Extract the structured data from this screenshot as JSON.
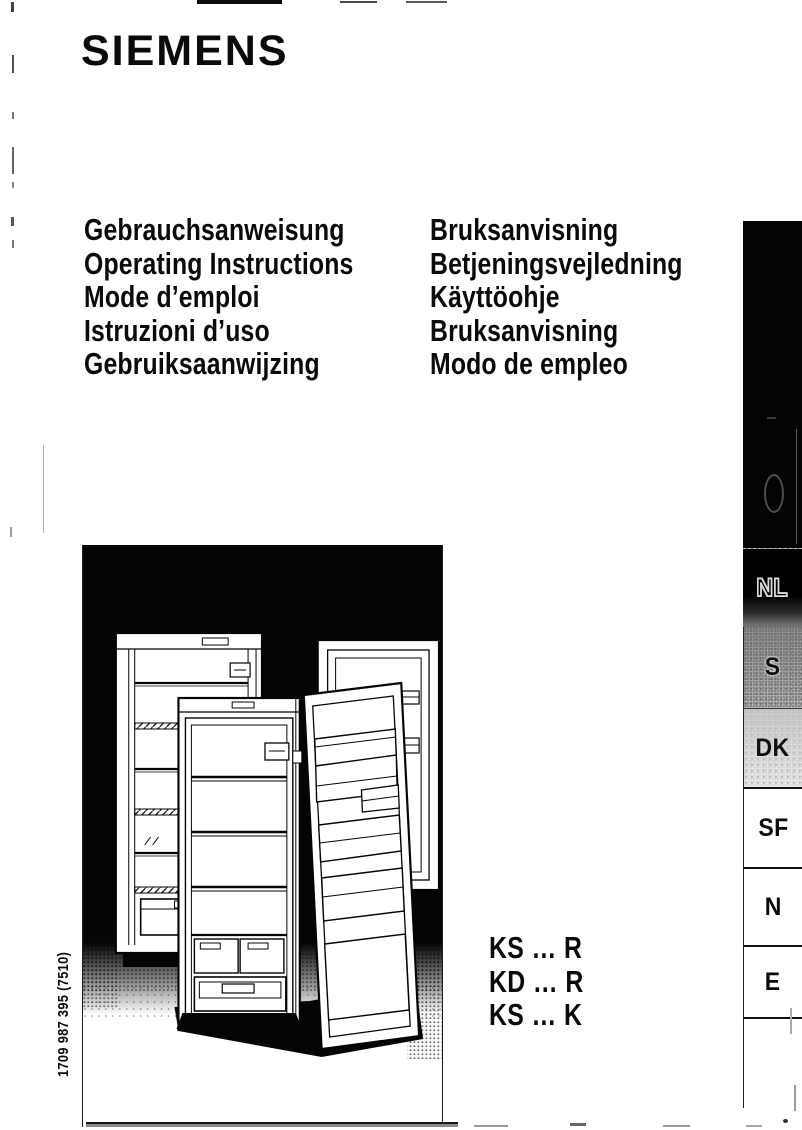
{
  "brand": {
    "logo": "SIEMENS"
  },
  "titles_left": [
    "Gebrauchsanweisung",
    "Operating Instructions",
    "Mode d’emploi",
    "Istruzioni d’uso",
    "Gebruiksaanwijzing"
  ],
  "titles_right": [
    "Bruksanvisning",
    "Betjeningsvejledning",
    "Käyttöohje",
    "Bruksanvisning",
    "Modo de empleo"
  ],
  "models": [
    "KS … R",
    "KD … R",
    "KS … K"
  ],
  "part_number": "1709 987 395 (7510)",
  "tabs": [
    {
      "label": "",
      "variant": "black-tall"
    },
    {
      "label": "NL",
      "variant": "black"
    },
    {
      "label": "S",
      "variant": "grey-dark"
    },
    {
      "label": "DK",
      "variant": "grey-light"
    },
    {
      "label": "SF",
      "variant": "white"
    },
    {
      "label": "N",
      "variant": "white"
    },
    {
      "label": "E",
      "variant": "white"
    },
    {
      "label": "",
      "variant": "empty"
    }
  ],
  "figure": {
    "name": "three-open-refrigerators-line-art"
  },
  "colors": {
    "ink": "#0a0a0a",
    "page": "#ffffff",
    "figure_background": "#050505",
    "tab_black": "#040404",
    "tab_grey_dark": "#8a8a8a",
    "tab_grey_light": "#c9c9c9"
  }
}
